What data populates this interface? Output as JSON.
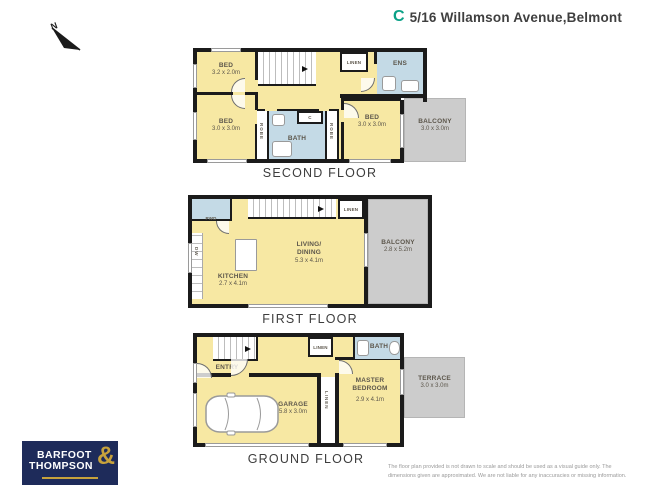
{
  "header": {
    "title": "5/16 Willamson Avenue,Belmont",
    "logo_glyph": "C",
    "logo_color": "#0aa187"
  },
  "compass": {
    "label": "N"
  },
  "colors": {
    "room_yellow": "#f7e8a3",
    "wet_area_blue": "#c4dae6",
    "outdoor_gray": "#cccccc",
    "wall_black": "#1b1b1b",
    "brand_navy": "#1e2b5a",
    "brand_gold": "#c7a23c"
  },
  "second_floor": {
    "label": "SECOND FLOOR",
    "bed1": {
      "name": "BED",
      "dims": "3.2 x 2.0m"
    },
    "bed2": {
      "name": "BED",
      "dims": "3.0 x 3.0m"
    },
    "bed3": {
      "name": "BED",
      "dims": "3.0 x 3.0m"
    },
    "bath": {
      "name": "BATH"
    },
    "ens": {
      "name": "ENS"
    },
    "linen": {
      "name": "LINEN"
    },
    "closet": {
      "name": "C"
    },
    "robe_left": {
      "name": "ROBE"
    },
    "robe_right": {
      "name": "ROBE"
    },
    "balcony": {
      "name": "BALCONY",
      "dims": "3.0 x 3.0m"
    }
  },
  "first_floor": {
    "label": "FIRST FLOOR",
    "living": {
      "line1": "LIVING/",
      "line2": "DINING",
      "dims": "5.3 x 4.1m"
    },
    "kitchen": {
      "name": "KITCHEN",
      "dims": "2.7 x 4.1m"
    },
    "pwd": {
      "name": "PWD"
    },
    "linen": {
      "name": "LINEN"
    },
    "dishwasher": {
      "name": "DW"
    },
    "balcony": {
      "name": "BALCONY",
      "dims": "2.8 x 5.2m"
    }
  },
  "ground_floor": {
    "label": "GROUND FLOOR",
    "entry": {
      "name": "ENTRY"
    },
    "garage": {
      "name": "GARAGE",
      "dims": "5.8 x 3.0m"
    },
    "master": {
      "line1": "MASTER",
      "line2": "BEDROOM",
      "dims": "2.9 x 4.1m"
    },
    "bath": {
      "name": "BATH"
    },
    "linen_hall": {
      "name": "LINEN"
    },
    "linen_robe": {
      "name": "LINEN"
    },
    "terrace": {
      "name": "TERRACE",
      "dims": "3.0 x 3.0m"
    }
  },
  "brand": {
    "line1": "BARFOOT",
    "line2": "THOMPSON",
    "ampersand": "&"
  },
  "disclaimer": {
    "line1": "The floor plan provided is not drawn to scale and should be used as a visual guide only. The",
    "line2": "dimensions given are approximated. We are not liable for any inaccuracies or missing information."
  }
}
